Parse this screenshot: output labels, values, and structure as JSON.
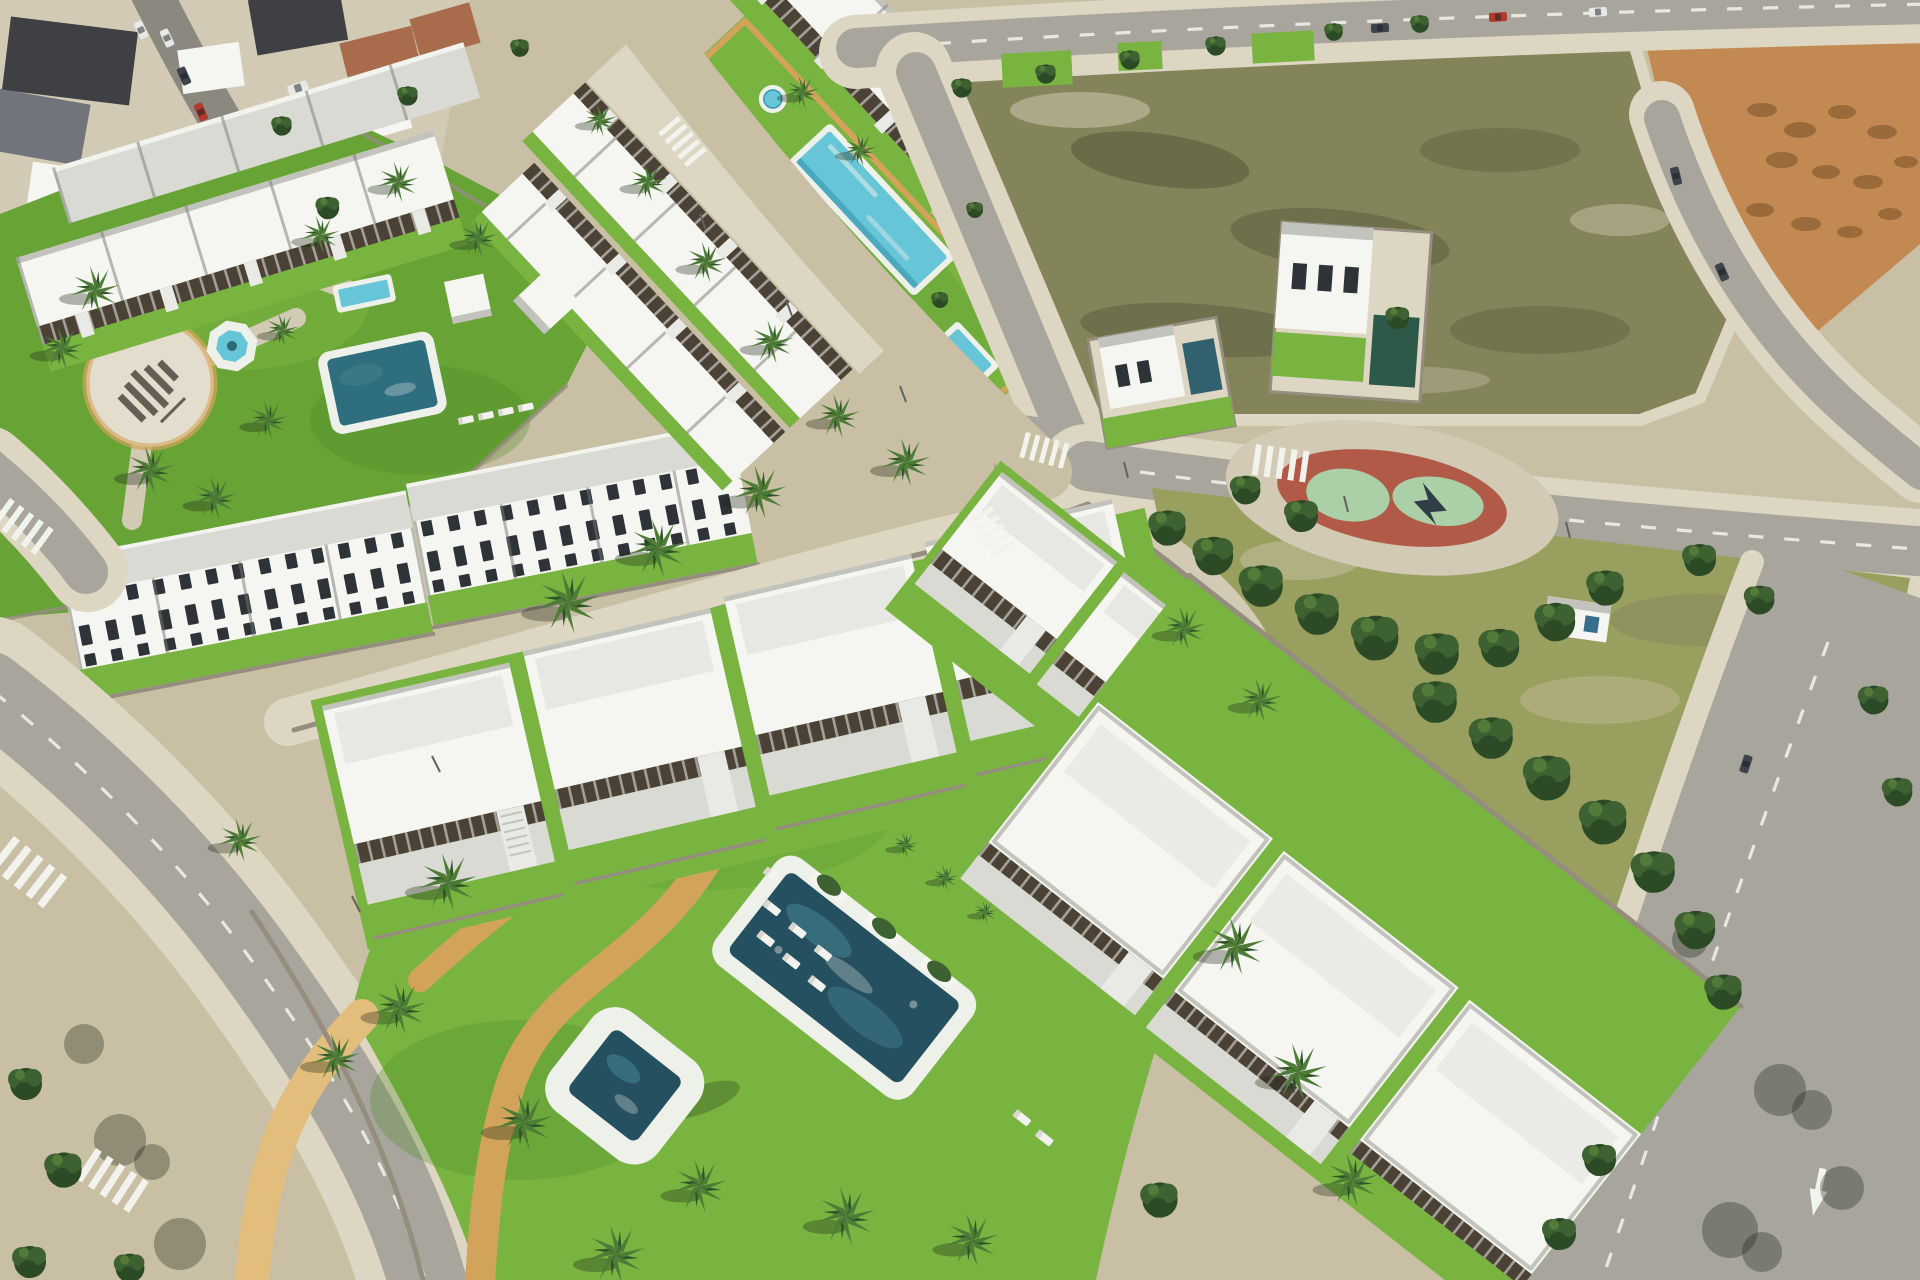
{
  "palette": {
    "sand": "#c9bfa5",
    "sandLight": "#ddd6c2",
    "sidewalk": "#d2cab4",
    "road": "#a8a59d",
    "roadDark": "#8b8880",
    "stripe": "#f3f3ee",
    "townRoof": "#3e4044",
    "townRoofGray": "#71747a",
    "terracotta": "#a86b4c",
    "white": "#f5f5f2",
    "buildingShade": "#d9dad4",
    "roofEdge": "#c2c3bc",
    "pergola": "#4b4135",
    "stair": "#e9e9e5",
    "lawn": "#68a336",
    "lawnBright": "#79b441",
    "lawnShade": "#4e8a28",
    "parkGrass": "#99a05f",
    "scrub": "#83845a",
    "scrubDark": "#5f6340",
    "dirtOrange": "#c28a52",
    "dirtOrangeDark": "#9a6a3b",
    "treeDark": "#2c4a26",
    "treeMid": "#3e6132",
    "treeLight": "#547a39",
    "palm": "#4c7c35",
    "palmDark": "#2f5526",
    "trunk": "#8a7a5e",
    "poolAqua": "#66c5d6",
    "poolAquaDeep": "#3796ac",
    "poolTeal": "#24505f",
    "poolTealLight": "#447e8e",
    "poolDeck": "#eef0ea",
    "pathTan": "#d2a45b",
    "pathTanLight": "#e2bd7c",
    "wall": "#958d7e",
    "glass": "#b9cdd2",
    "playRed": "#b15a48",
    "playMint": "#abcfa7",
    "carRed": "#b03a2e",
    "carDark": "#3f444c",
    "carWhite": "#e8e8e6",
    "shadow": "rgba(25,35,18,0.32)"
  }
}
